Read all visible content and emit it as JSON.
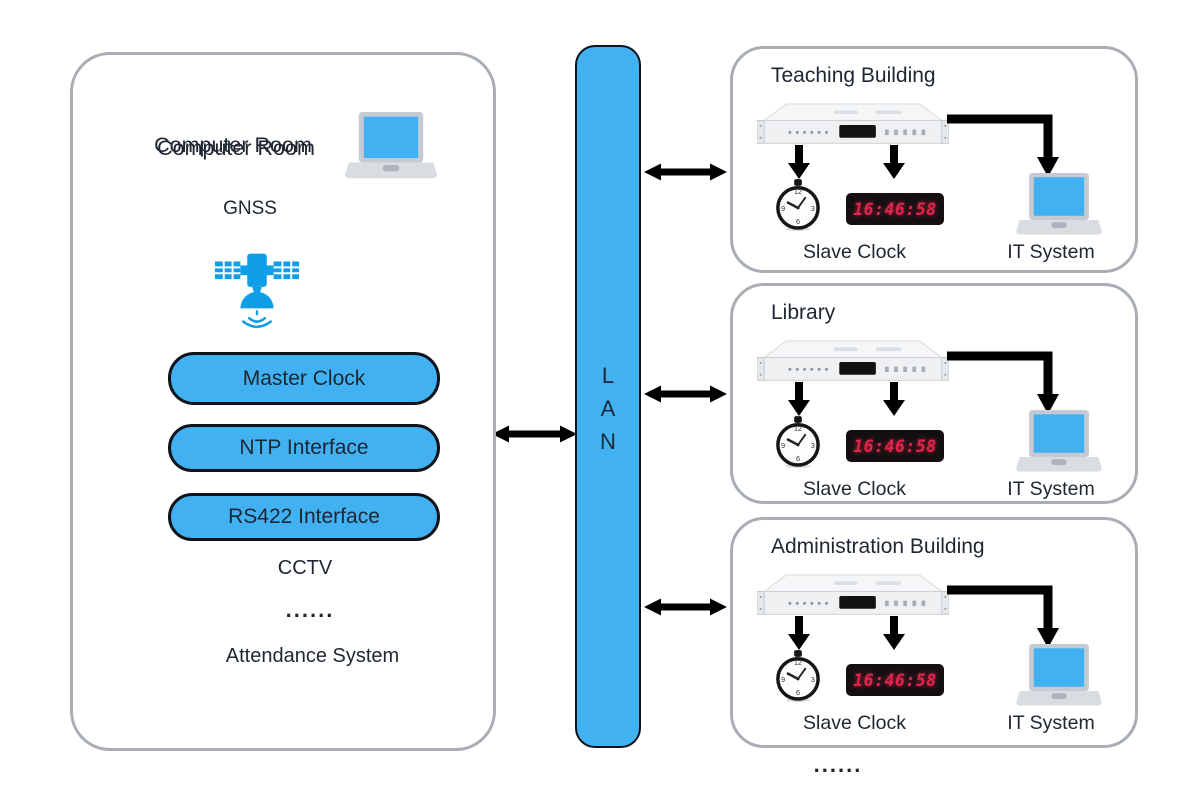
{
  "colors": {
    "accent": "#41b1f2",
    "satellite_blue": "#0f9fe8",
    "led_red": "#e3244b",
    "ink": "#1d2631",
    "frame_gray": "#a9aeb4"
  },
  "computer_room": {
    "title": "Computer Room",
    "gnss_label": "GNSS",
    "nodes": [
      {
        "label": "Master Clock"
      },
      {
        "label": "NTP Interface"
      },
      {
        "label": "RS422 Interface"
      }
    ],
    "peripherals": [
      "CCTV",
      "......",
      "Attendance System"
    ]
  },
  "lan": {
    "letters": [
      "L",
      "A",
      "N"
    ]
  },
  "buildings": [
    {
      "title": "Teaching Building",
      "slave_label": "Slave Clock",
      "it_label": "IT System",
      "time": "16:46:58"
    },
    {
      "title": "Library",
      "slave_label": "Slave Clock",
      "it_label": "IT System",
      "time": "16:46:58"
    },
    {
      "title": "Administration Building",
      "slave_label": "Slave Clock",
      "it_label": "IT System",
      "time": "16:46:58"
    }
  ],
  "more_indicator": "......",
  "icons": {
    "workstation": "laptop-icon",
    "gnss": "satellite-icon",
    "ntp_server": "rack-server-icon",
    "slave_clock": "analog-clock-icon",
    "digital_display": "digital-clock-icon",
    "it_system": "laptop-icon",
    "link": "double-headed-arrow-icon"
  }
}
